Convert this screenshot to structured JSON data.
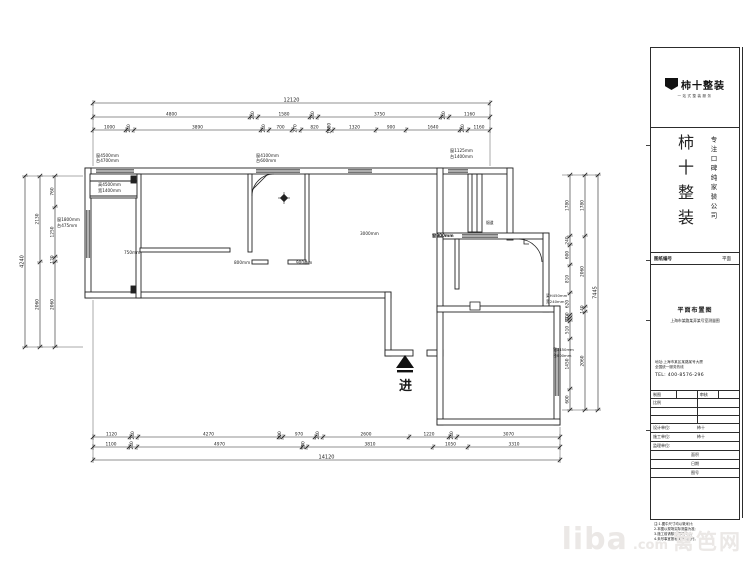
{
  "floorplan": {
    "dim_chains": [
      {
        "o": "h",
        "y": 103,
        "b": [
          93,
          490
        ],
        "labels": [
          "12120"
        ],
        "s": 5
      },
      {
        "o": "h",
        "y": 117,
        "b": [
          93,
          250,
          258,
          310,
          318,
          441,
          449,
          490
        ],
        "labels": [
          "4800",
          "240",
          "1580",
          "240",
          "3750",
          "240",
          "1160"
        ],
        "s": 4.3
      },
      {
        "o": "h",
        "y": 130,
        "b": [
          93,
          126,
          134,
          261,
          269,
          292,
          301,
          328,
          333,
          376,
          406,
          460,
          468,
          490
        ],
        "labels": [
          "1000",
          "240",
          "3890",
          "240",
          "700",
          "270",
          "820",
          "1080",
          "1320",
          "900",
          "1640",
          "240",
          "1160"
        ],
        "s": 4.3
      },
      {
        "o": "v",
        "x": 25,
        "b": [
          176,
          347
        ],
        "labels": [
          "4240"
        ],
        "s": 5
      },
      {
        "o": "v",
        "x": 40,
        "b": [
          176,
          262,
          347
        ],
        "labels": [
          "2130",
          "2060"
        ],
        "s": 4.3
      },
      {
        "o": "v",
        "x": 55,
        "b": [
          176,
          207,
          257,
          262,
          347
        ],
        "labels": [
          "760",
          "1250",
          "120",
          "2060"
        ],
        "s": 4.3
      },
      {
        "o": "v",
        "x": 598,
        "b": [
          175,
          410
        ],
        "labels": [
          "7445"
        ],
        "s": 5
      },
      {
        "o": "v",
        "x": 585,
        "b": [
          175,
          236,
          307,
          312,
          410
        ],
        "labels": [
          "1780",
          "2060",
          "140",
          "2060"
        ],
        "s": 4.3
      },
      {
        "o": "v",
        "x": 570,
        "b": [
          175,
          236,
          245,
          265,
          293,
          315,
          318,
          321,
          339,
          389,
          410
        ],
        "labels": [
          "1780",
          "240",
          "600",
          "810",
          "620",
          "100",
          "90",
          "510",
          "1450",
          "600"
        ],
        "s": 4.3
      },
      {
        "o": "h",
        "y": 437,
        "b": [
          93,
          130,
          138,
          279,
          283,
          315,
          323,
          409,
          449,
          457,
          560
        ],
        "labels": [
          "1120",
          "240",
          "4270",
          "100",
          "970",
          "240",
          "2600",
          "1220",
          "240",
          "3070"
        ],
        "s": 4.3
      },
      {
        "o": "h",
        "y": 447,
        "b": [
          93,
          129,
          137,
          302,
          307,
          433,
          468,
          560
        ],
        "labels": [
          "1100",
          "240",
          "4970",
          "150",
          "3810",
          "1050",
          "3310"
        ],
        "s": 4.3
      },
      {
        "o": "h",
        "y": 460,
        "b": [
          93,
          560
        ],
        "labels": [
          "14120"
        ],
        "s": 5
      }
    ],
    "annotations": [
      {
        "x": 96,
        "y": 157,
        "t": "窗4500mm",
        "s": 4.2
      },
      {
        "x": 96,
        "y": 162,
        "t": "台4700mm",
        "s": 4.2
      },
      {
        "x": 98,
        "y": 186,
        "t": "高4500mm",
        "s": 4.2
      },
      {
        "x": 98,
        "y": 192,
        "t": "宽1400mm",
        "s": 4.2
      },
      {
        "x": 57,
        "y": 221,
        "t": "窗1800mm",
        "s": 4.2
      },
      {
        "x": 57,
        "y": 227,
        "t": "台475mm",
        "s": 4.2
      },
      {
        "x": 124,
        "y": 254,
        "t": "750mm",
        "s": 4.2
      },
      {
        "x": 256,
        "y": 157,
        "t": "窗4100mm",
        "s": 4.2
      },
      {
        "x": 256,
        "y": 162,
        "t": "台600mm",
        "s": 4.2
      },
      {
        "x": 234,
        "y": 264,
        "t": "800mm",
        "s": 4.2
      },
      {
        "x": 296,
        "y": 264,
        "t": "900mm",
        "s": 4.2
      },
      {
        "x": 360,
        "y": 235,
        "t": "3000mm",
        "s": 4.2
      },
      {
        "x": 450,
        "y": 152,
        "t": "窗1125mm",
        "s": 4.2
      },
      {
        "x": 450,
        "y": 158,
        "t": "台1400mm",
        "s": 4.2
      },
      {
        "x": 432,
        "y": 237,
        "t": "窗900mm",
        "s": 4.2,
        "b": 1
      },
      {
        "x": 486,
        "y": 224,
        "t": "烟道",
        "s": 3.8
      },
      {
        "x": 546,
        "y": 297,
        "t": "梁H450mm",
        "s": 3.8
      },
      {
        "x": 546,
        "y": 303,
        "t": "宽240mm",
        "s": 3.8
      },
      {
        "x": 553,
        "y": 351,
        "t": "窗1450mm",
        "s": 3.8
      },
      {
        "x": 553,
        "y": 357,
        "t": "台600mm",
        "s": 3.8
      },
      {
        "x": 399,
        "y": 390,
        "t": "进",
        "s": 13,
        "b": 1
      }
    ]
  },
  "titleblock": {
    "logo": {
      "name": "柿十整装",
      "sub": "一站式整装服务"
    },
    "brand": "柿十整装",
    "slogan": "专注口碑纯家装公司",
    "row1": {
      "left": "图纸编号",
      "right": "平面"
    },
    "panel": {
      "title": "平面布置图",
      "line1": "上海市某路某弄某号室测量图",
      "addr1": "地址:上海市某区某路某号大厦",
      "addr2": "全国统一服务热线",
      "tel": "TEL: 400-8576-296"
    },
    "table": {
      "r1a": "制图",
      "r1b": "",
      "r1c": "审核",
      "r1d": "",
      "r2": "比例",
      "r5l": "设计单位:",
      "r5r": "柿十",
      "r6l": "施工单位:",
      "r6r": "柿十",
      "r7l": "监理单位:",
      "r7r": "",
      "r8": "面积",
      "r9": "日期",
      "r10": "图号"
    },
    "notes": [
      "注:1.图中尺寸均以毫米计;",
      "2.本图以现场实际测量为准;",
      "3.施工前请核对现场尺寸;",
      "4.未尽事宜按相关规范执行。"
    ]
  },
  "watermark": {
    "liba": "liba",
    "com": ".com",
    "cn": "篱笆网"
  }
}
